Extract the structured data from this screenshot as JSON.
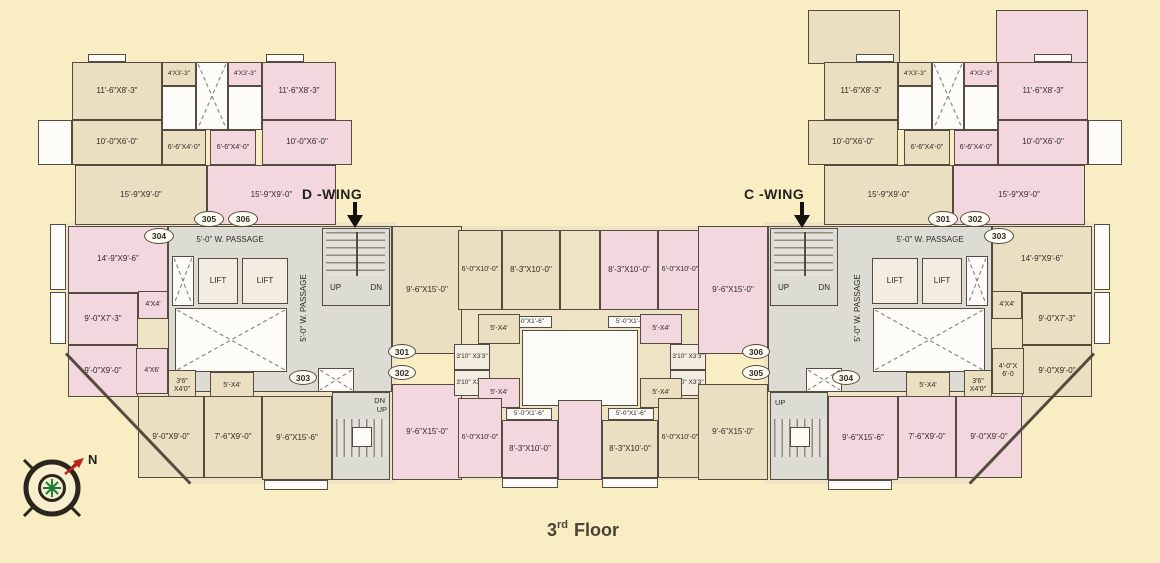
{
  "floor": {
    "number": "3",
    "ordinal": "rd",
    "word": "Floor"
  },
  "compass": {
    "north": "N"
  },
  "wings": {
    "d": {
      "label": "D -WING"
    },
    "c": {
      "label": "C -WING"
    }
  },
  "flats": {
    "f301": "301",
    "f302": "302",
    "f303": "303",
    "f304": "304",
    "f305": "305",
    "f306": "306"
  },
  "core": {
    "passage": "5'-0\" W. PASSAGE",
    "lift": "LIFT",
    "up": "UP",
    "dn": "DN"
  },
  "dims": {
    "bed_11_6x8_3": "11'-6\"X8'-3\"",
    "bal_4x3_3": "4'X3'-3\"",
    "rm_10_0x6_0": "10'-0\"X6'-0\"",
    "rm_6_6x4_0": "6'-6\"X4'-0\"",
    "rm_15_9x9_0": "15'-9\"X9'-0\"",
    "rm_14_9x9_6": "14'-9\"X9'-6\"",
    "rm_4x4": "4'X4'",
    "rm_9_0x7_3": "9'-0\"X7'-3\"",
    "rm_9_0x9_0": "9'-0\"X9'-0\"",
    "rm_4x6": "4'X6'",
    "rm_4_0x6_0": "4'-0\"X 6'-0",
    "rm_3_6x4_0": "3'6\" X4'0\"",
    "rm_5x4": "5'-X4'",
    "rm_9_6x15_0": "9'-6\"X15'-0\"",
    "rm_9_6x15_6": "9'-6\"X15'-6\"",
    "rm_7_6x9_0": "7'-6\"X9'-0\"",
    "rm_6_0x10_0": "6'-0\"X10'-0\"",
    "rm_8_3x10_0": "8'-3\"X10'-0\"",
    "ledge_5_0x1_6": "5'-0\"X1'-6\"",
    "rm_3_10x3_3": "3'10\" X3'3\""
  },
  "colors": {
    "background": "#f9edc3",
    "room_pink": "#f3d7de",
    "room_beige": "#ebdfc1",
    "core_gray": "#dcdbd4",
    "wall": "#554b3e",
    "north_arrow_red": "#c32222",
    "compass_green": "#1d7a3f"
  }
}
